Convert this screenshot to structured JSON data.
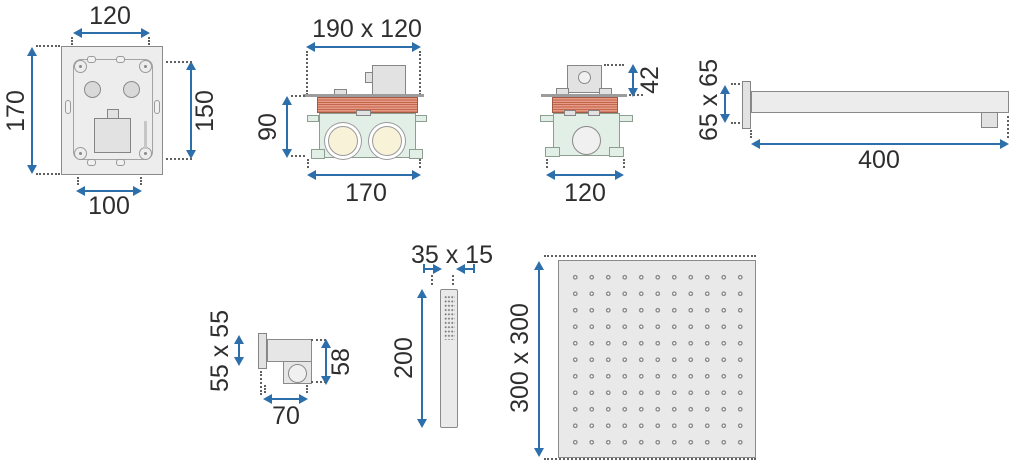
{
  "diagram": {
    "kind": "technical-drawing",
    "colors": {
      "arrow_blue": "#2d6fab",
      "hatch_red_base": "#e79a84",
      "hatch_red_line": "#c2664e",
      "body_green": "#e2efe6",
      "port_cream": "#f7f2d8",
      "part_gray": "#ededed"
    },
    "figures": {
      "mixer_front": {
        "dim_top": "120",
        "dim_left": "170",
        "dim_right": "150",
        "dim_bottom": "100"
      },
      "mixer_side": {
        "dim_top": "190 x 120",
        "dim_left": "90",
        "dim_bottom": "170"
      },
      "mixer_end": {
        "dim_right": "42",
        "dim_bottom": "120"
      },
      "shower_arm": {
        "dim_left": "65 x 65",
        "dim_bottom": "400"
      },
      "wall_holder": {
        "dim_left": "55 x 55",
        "dim_right": "58",
        "dim_bottom": "70"
      },
      "hand_shower": {
        "dim_top": "35 x 15",
        "dim_left": "200"
      },
      "head_shower": {
        "dim_left": "300 x 300"
      }
    }
  }
}
